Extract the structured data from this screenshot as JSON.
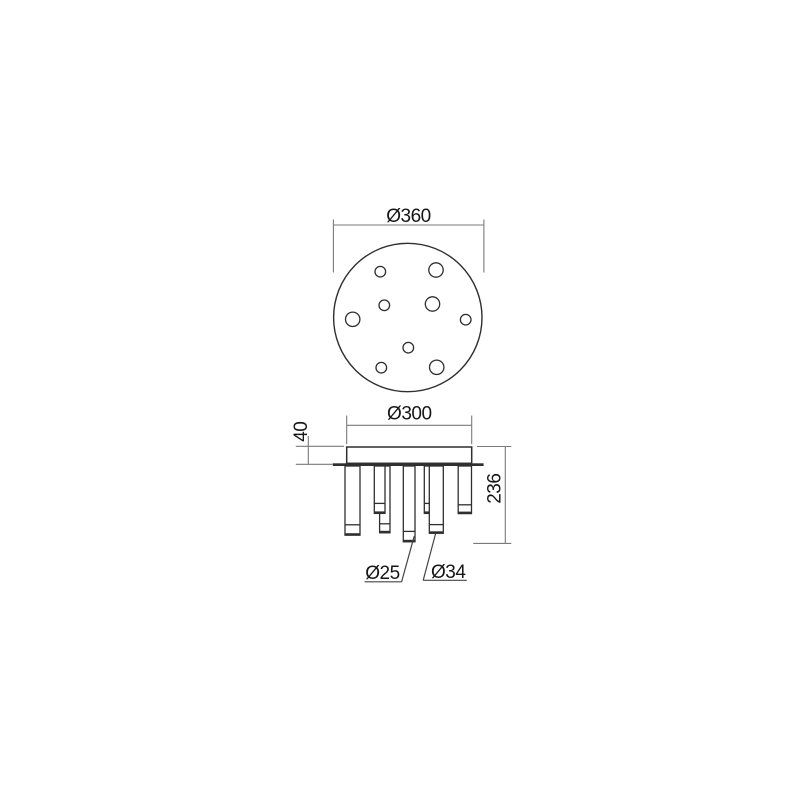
{
  "colors": {
    "ink": "#2f2f2f",
    "dim_line": "#7a7a7a",
    "leader": "#454545",
    "text": "#161616",
    "background": "#ffffff"
  },
  "drawing": {
    "type": "technical-dimension-drawing",
    "top_view": {
      "outer_diameter_label": "Ø360",
      "hole_count_large": 4,
      "hole_count_small": 5
    },
    "side_view": {
      "canopy_diameter_label": "Ø300",
      "canopy_height_label": "40",
      "fixture_height_label": "236",
      "small_tube_diameter_label": "Ø25",
      "large_tube_diameter_label": "Ø34"
    }
  }
}
